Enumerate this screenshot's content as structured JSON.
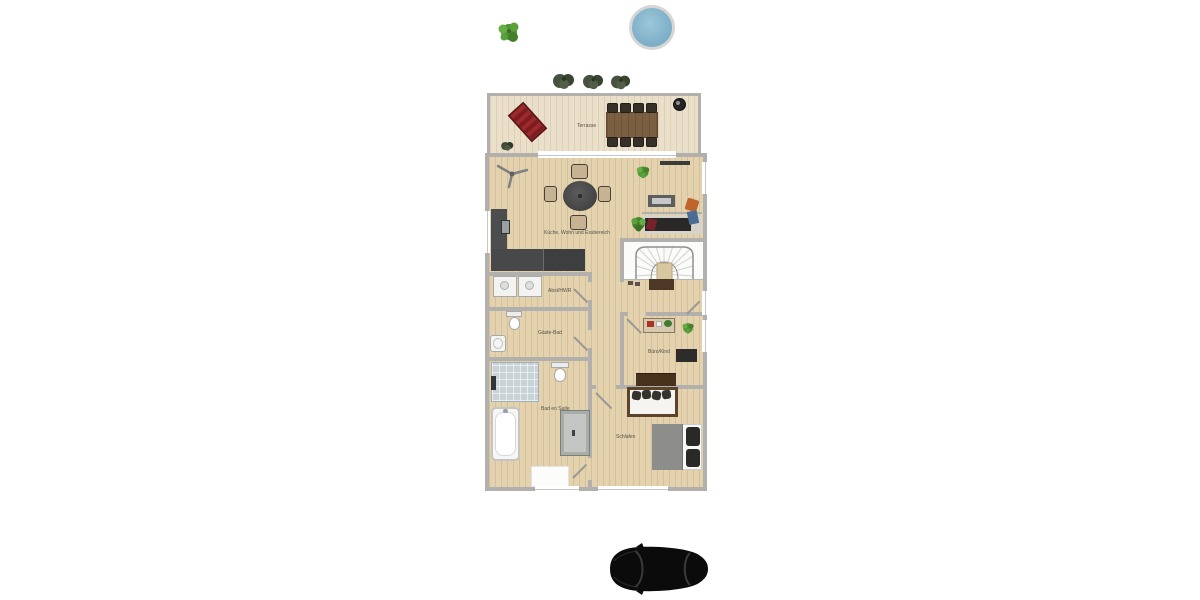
{
  "scene": {
    "type": "residential floor plan, top-down 2D render on white background",
    "background": "#ffffff"
  },
  "rooms": {
    "terrace": {
      "label": "Terrasse"
    },
    "living": {
      "label": "Küche, Wohn und Essbereich"
    },
    "utility": {
      "label": "Abst/HWR"
    },
    "guest_bath": {
      "label": "Gäste-Bad"
    },
    "ensuite_bath": {
      "label": "Bad en Suite"
    },
    "office": {
      "label": "Büro/Kind"
    },
    "bedroom": {
      "label": "Schlafen"
    }
  },
  "outdoor": {
    "items": [
      "tree",
      "round-pool",
      "hedge-bushes",
      "car-top-view"
    ]
  },
  "furniture": {
    "terrace": [
      "sun-lounger",
      "outdoor-dining-table",
      "eight-outdoor-chairs",
      "grill",
      "potted-plant"
    ],
    "living": [
      "ceiling-fan",
      "round-dining-table",
      "four-dining-chairs",
      "l-shaped-kitchen-counter",
      "kitchen-sink",
      "tv-sideboard",
      "sofa",
      "orange-armchair",
      "plants"
    ],
    "utility": [
      "washer",
      "dryer"
    ],
    "guest_bath": [
      "toilet",
      "washbasin"
    ],
    "ensuite_bath": [
      "walk-in-shower",
      "toilet",
      "bathtub",
      "vanity-cabinet",
      "bath-mat"
    ],
    "office": [
      "play-table",
      "dark-desk",
      "plant",
      "sideboard"
    ],
    "bedroom": [
      "daybed-with-pillows",
      "double-bed"
    ],
    "hall": [
      "winder-staircase",
      "doormat",
      "shoes"
    ]
  },
  "colors": {
    "wall": "#b2b0ad",
    "terrace_floor": "#eadfc8",
    "interior_floor": "#e3d2ad",
    "stair_floor": "#fbfbfa",
    "kitchen_counter": "#47494a",
    "pool_water": "#82b3cb",
    "pool_rim": "#d6d6d4",
    "tree_green": "#58a03c",
    "bush_green": "#46523f",
    "lounger_red": "#8c1f24",
    "outdoor_table_brown": "#7c5e40",
    "sofa_cushion": "#2a2827",
    "accent_orange": "#bf652c",
    "accent_blue": "#4a6b94",
    "bed_blanket": "#8d8d8b",
    "pillow_dark": "#2b2928",
    "dark_wood": "#48321d",
    "car_black": "#0b0b0b",
    "label_text": "#56514a"
  }
}
